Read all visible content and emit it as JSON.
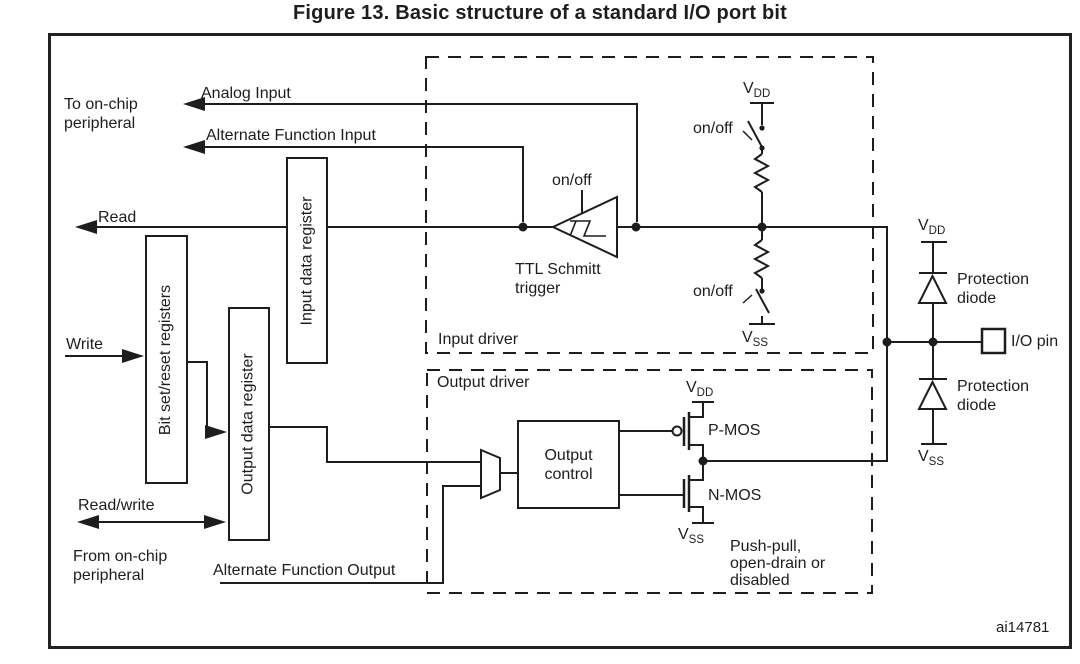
{
  "figure": {
    "title": "Figure 13. Basic structure of a standard I/O port bit",
    "figure_code": "ai14781"
  },
  "labels": {
    "to_on_chip_line1": "To on-chip",
    "to_on_chip_line2": "peripheral",
    "analog_input": "Analog Input",
    "alternate_function_input": "Alternate Function Input",
    "read": "Read",
    "write": "Write",
    "read_write": "Read/write",
    "from_on_chip_line1": "From on-chip",
    "from_on_chip_line2": "peripheral",
    "alternate_function_output": "Alternate Function Output",
    "on_off": "on/off",
    "ttl_schmitt_line1": "TTL Schmitt",
    "ttl_schmitt_line2": "trigger",
    "input_driver": "Input driver",
    "output_driver": "Output driver",
    "output_control_line1": "Output",
    "output_control_line2": "control",
    "pmos": "P-MOS",
    "nmos": "N-MOS",
    "push_pull_line1": "Push-pull,",
    "push_pull_line2": "open-drain or",
    "push_pull_line3": "disabled",
    "protection_line1": "Protection",
    "protection_line2": "diode",
    "io_pin": "I/O pin",
    "v": "V",
    "dd": "DD",
    "ss": "SS"
  },
  "registers": {
    "bit_set_reset": "Bit set/reset registers",
    "input_data": "Input data register",
    "output_data": "Output data register"
  },
  "colors": {
    "line": "#1d1d1d",
    "background": "#ffffff"
  }
}
